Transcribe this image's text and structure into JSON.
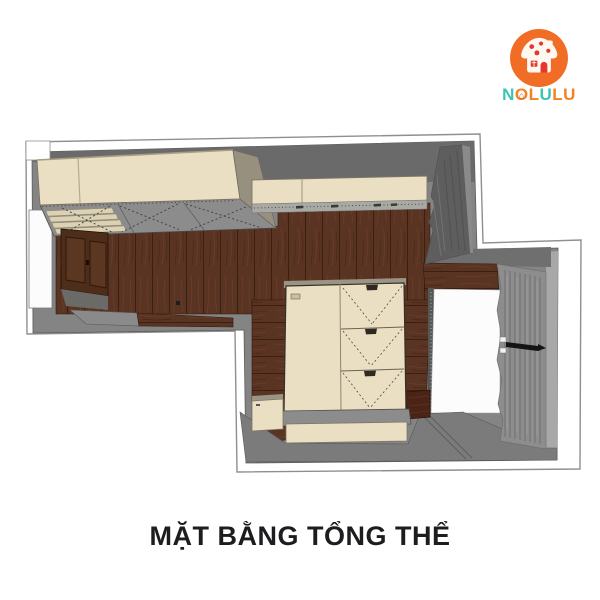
{
  "logo": {
    "brand": "NOLULU",
    "badge_color": "#f16c24",
    "house_accent": "#e6372e",
    "letters": [
      {
        "ch": "N",
        "color": "#3cc3b1",
        "house": false
      },
      {
        "ch": "O",
        "color": "#f58220",
        "house": true
      },
      {
        "ch": "L",
        "color": "#f58220",
        "house": false
      },
      {
        "ch": "U",
        "color": "#3cc3b1",
        "house": false
      },
      {
        "ch": "L",
        "color": "#f58220",
        "house": false
      },
      {
        "ch": "U",
        "color": "#f58220",
        "house": false
      }
    ]
  },
  "caption": {
    "title": "MẶT BẰNG TỔNG THỂ"
  },
  "plan_colors": {
    "white": "#ffffff",
    "near_white": "#fcfcfc",
    "outline": "#909090",
    "wall": "#848484",
    "wall_dark": "#6a6a6a",
    "wall_darker": "#5e5e5e",
    "floor": "#7b7b7b",
    "platform": "#8c8c8c",
    "slat": "#dcd2b3",
    "cream": "#eadfc3",
    "beige_side": "#97907f",
    "wood": "#5a3423",
    "dark_cabinet": "#4e2d1b",
    "curtain": "#8d8d8d",
    "curtain_dark": "#6e6e6e",
    "light_strip": "#a8a8a8",
    "counter": "#a9a9a4",
    "step": "#8c8c8c",
    "rail_black": "#141414"
  }
}
